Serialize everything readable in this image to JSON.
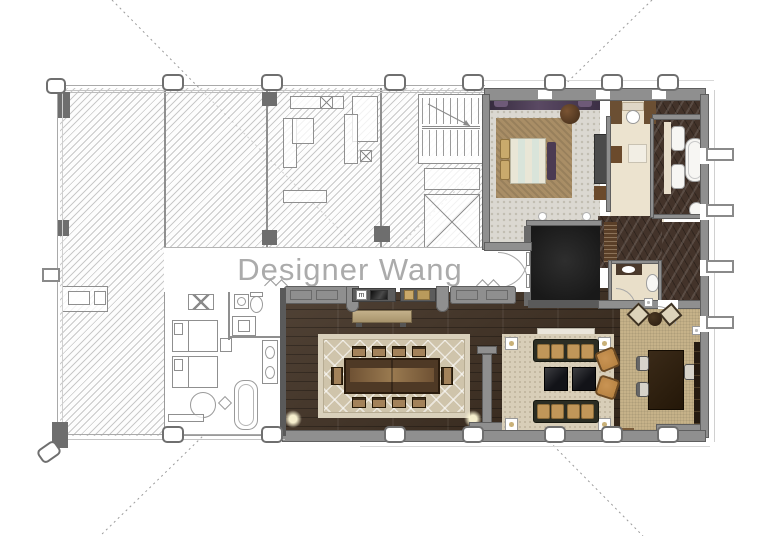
{
  "watermark": {
    "text": "Designer Wang"
  },
  "icons": {
    "minibar_label": "m"
  },
  "colors": {
    "canvas-bg": "#ffffff",
    "watermark-gray": "#ababab",
    "hatch-line": "#9e9e9e",
    "cad-dark": "#6e6e6e",
    "wall-gray": "#8f8f8f",
    "wood-floor": "#3d2d1f",
    "carpet-gray": "#dbd8d1",
    "carpet-dot": "#c2beb2",
    "rug-cream": "#cfc4ab",
    "rug-tan": "#a98e66",
    "study-carpet": "#c6b289",
    "cream-floor": "#ece3cf",
    "marble-dark": "#43332a",
    "purple-accent": "#4b3a52",
    "foyer-black": "#191919",
    "sofa-dark": "#2b2d23",
    "cushion-tan": "#c09659",
    "chair-orange": "#b5803f",
    "bed-cream": "#ece9d9"
  }
}
